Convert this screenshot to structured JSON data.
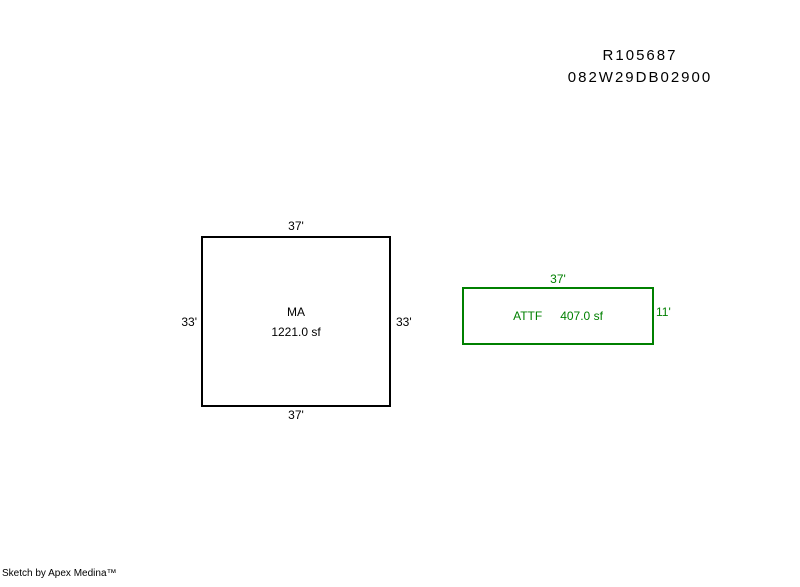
{
  "colors": {
    "background": "#ffffff",
    "ink": "#000000",
    "sketch_green": "#008000"
  },
  "header": {
    "account_number": "R105687",
    "map_taxlot": "082W29DB02900"
  },
  "sketch": {
    "main_area": {
      "code": "MA",
      "area": "1221.0 sf",
      "dim_top": "37'",
      "dim_bottom": "37'",
      "dim_left": "33'",
      "dim_right": "33'"
    },
    "attached_area": {
      "code": "ATTF",
      "area": "407.0 sf",
      "dim_top": "37'",
      "dim_right": "11'"
    }
  },
  "footer": {
    "credit": "Sketch by Apex Medina™"
  }
}
